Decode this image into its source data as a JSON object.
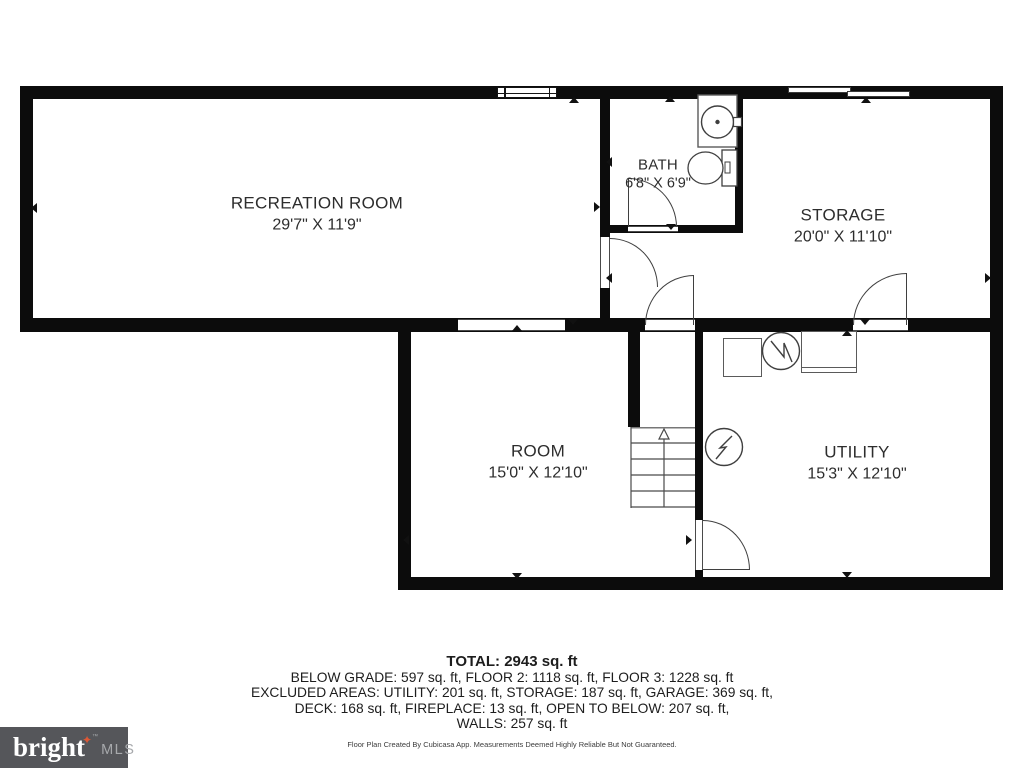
{
  "floor_plan": {
    "wall_color": "#0c0c0c",
    "rooms": [
      {
        "id": "recreation-room",
        "name": "RECREATION ROOM",
        "dimensions": "29'7\" X 11'9\""
      },
      {
        "id": "bath",
        "name": "BATH",
        "dimensions": "6'8\" X 6'9\""
      },
      {
        "id": "storage",
        "name": "STORAGE",
        "dimensions": "20'0\" X 11'10\""
      },
      {
        "id": "room",
        "name": "ROOM",
        "dimensions": "15'0\" X 12'10\""
      },
      {
        "id": "utility",
        "name": "UTILITY",
        "dimensions": "15'3\" X 12'10\""
      }
    ],
    "fixtures": [
      "sink",
      "toilet",
      "staircase-up",
      "furnace",
      "water-heater",
      "hvac-unit",
      "appliance"
    ]
  },
  "summary": {
    "total": "TOTAL: 2943 sq. ft",
    "line1": "BELOW GRADE: 597 sq. ft, FLOOR 2: 1118 sq. ft, FLOOR 3: 1228 sq. ft",
    "line2": "EXCLUDED AREAS: UTILITY: 201 sq. ft, STORAGE: 187 sq. ft, GARAGE: 369 sq. ft,",
    "line3": "DECK: 168 sq. ft, FIREPLACE: 13 sq. ft, OPEN TO BELOW: 207 sq. ft,",
    "line4": "WALLS: 257 sq. ft",
    "disclaimer": "Floor Plan Created By Cubicasa App. Measurements Deemed Highly Reliable But Not Guaranteed."
  },
  "branding": {
    "logo_text": "bright",
    "logo_star": "✦",
    "logo_tm": "™",
    "logo_suffix": "MLS",
    "background": "#55565a",
    "star_color": "#dd5835",
    "text_color": "#ffffff",
    "suffix_color": "#a7a9ac"
  }
}
